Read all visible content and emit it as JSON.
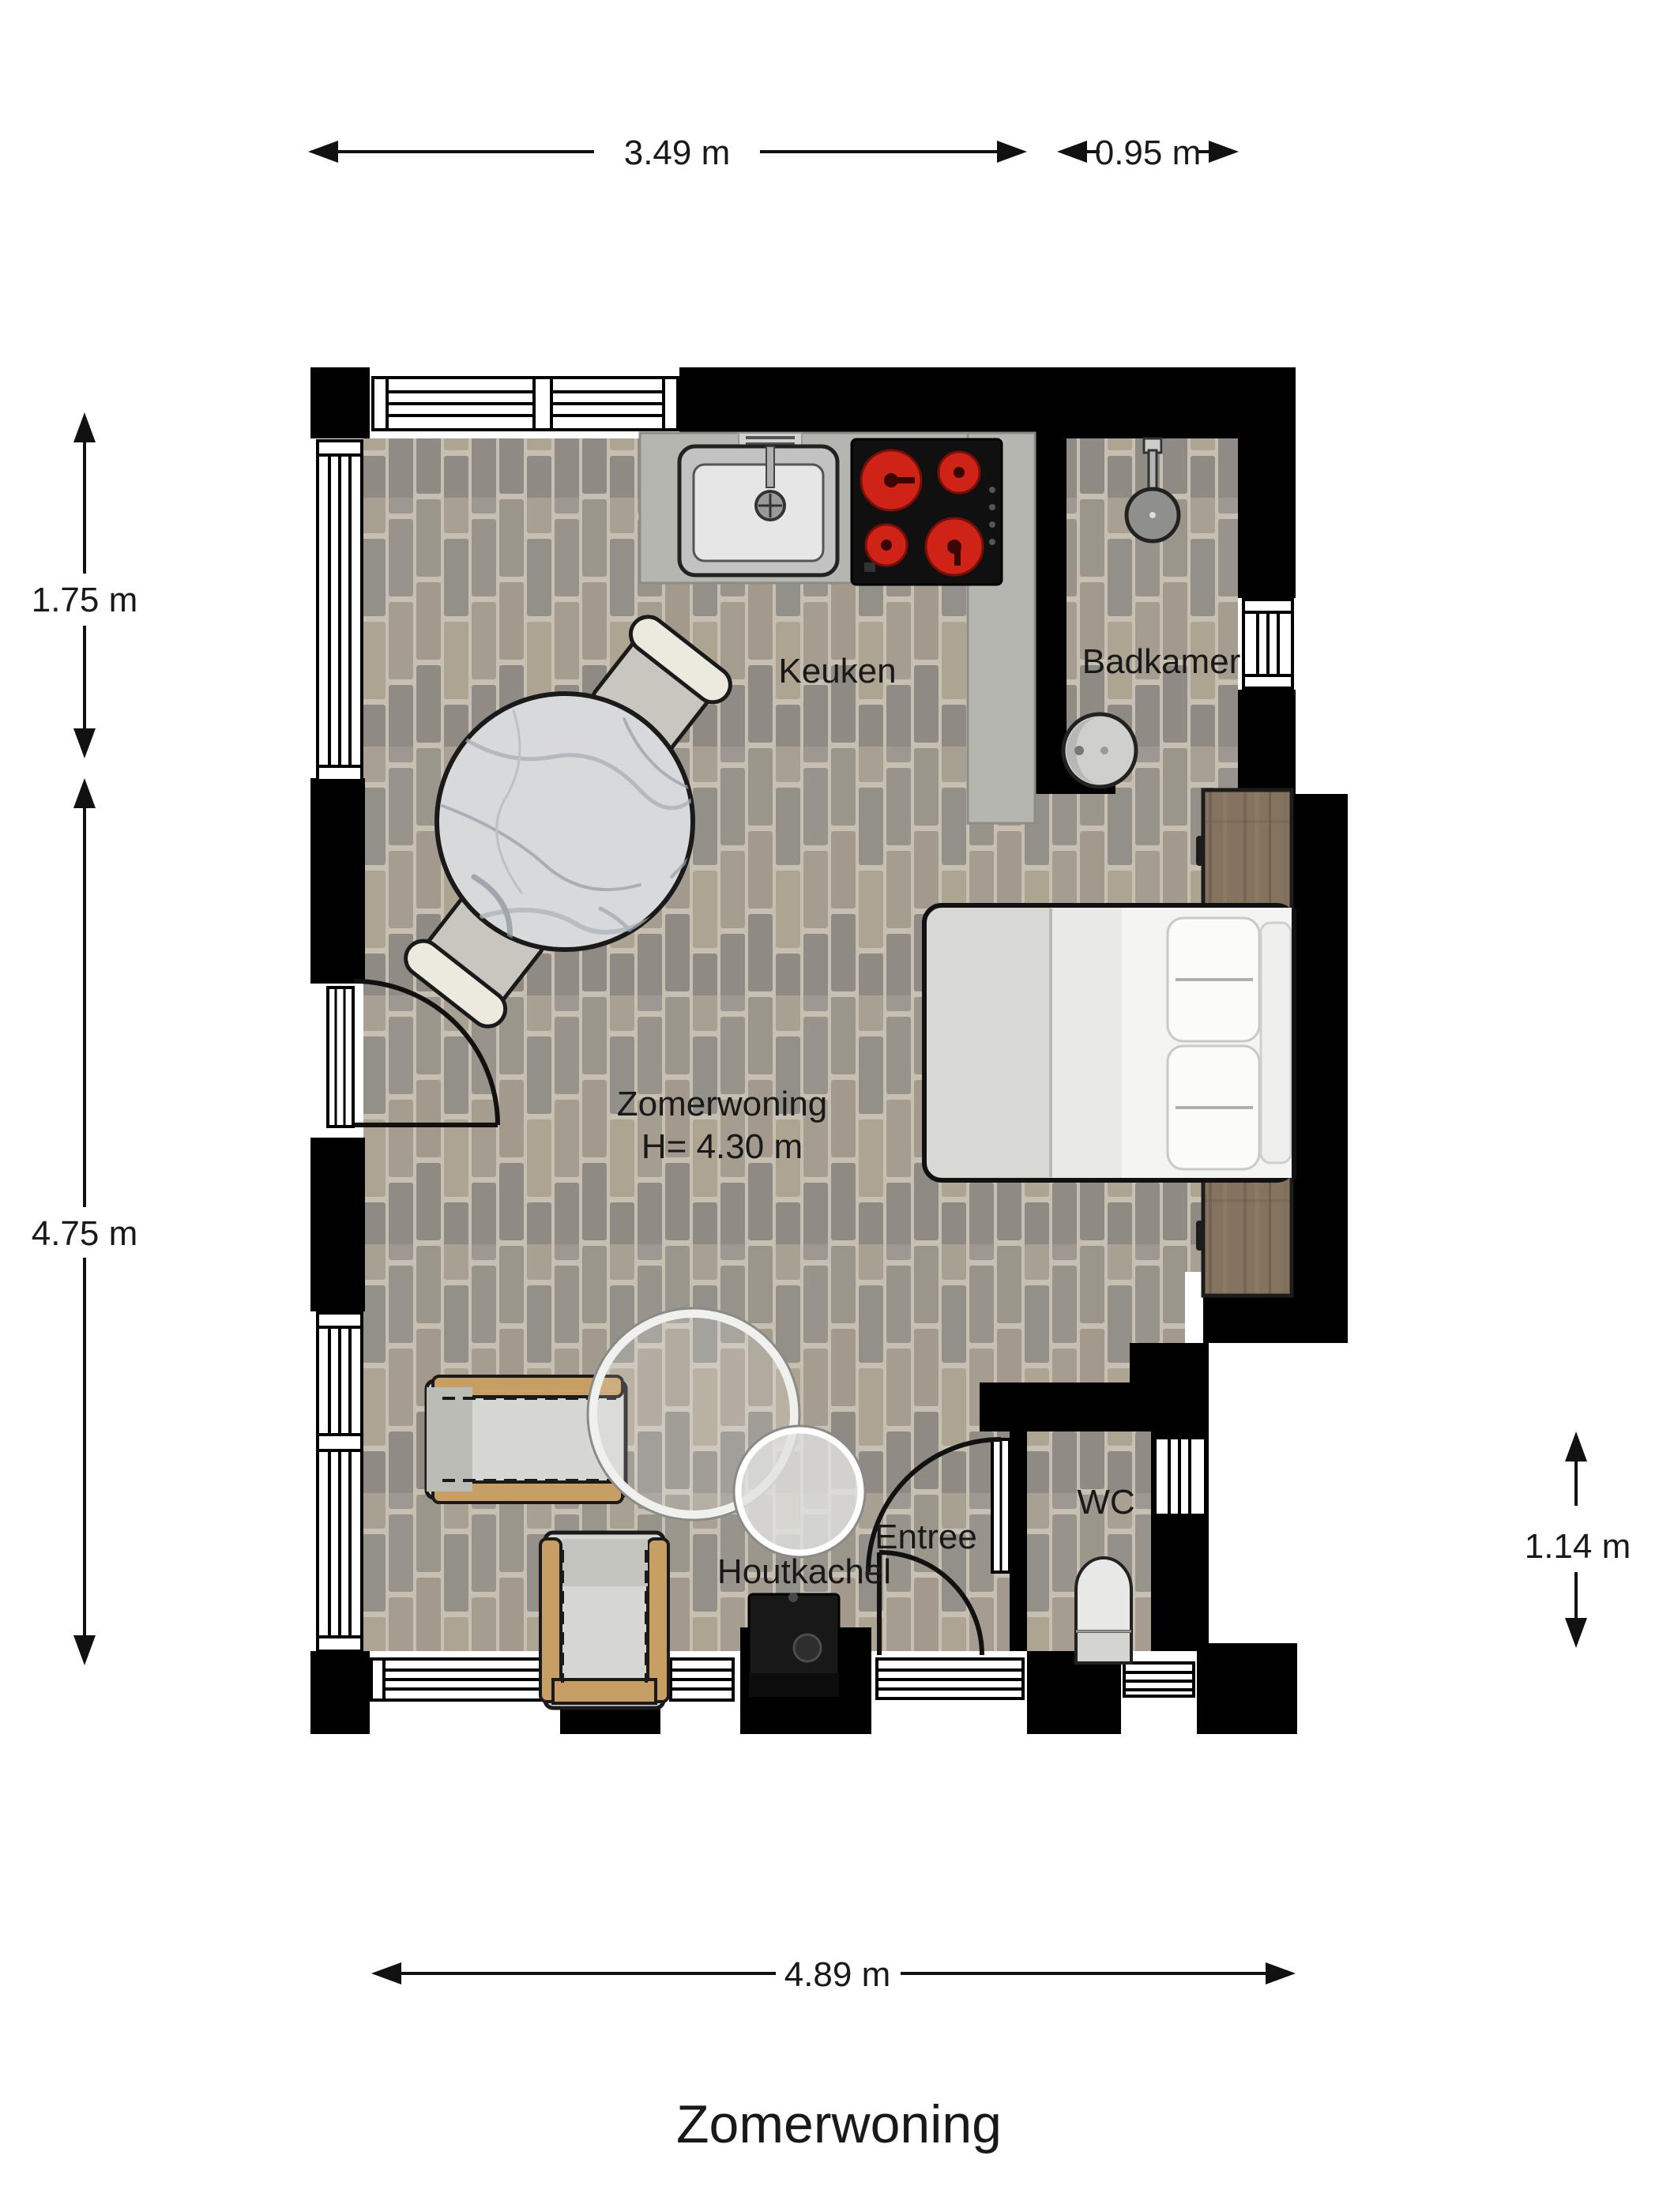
{
  "title": "Zomerwoning",
  "labels": {
    "keuken": "Keuken",
    "badkamer": "Badkamer",
    "main_line1": "Zomerwoning",
    "main_line2": "H= 4.30 m",
    "houtkachel": "Houtkachel",
    "entree": "Entree",
    "wc": "WC"
  },
  "dimensions": {
    "top_left": "3.49 m",
    "top_right": "0.95 m",
    "left_upper": "1.75 m",
    "left_lower": "4.75 m",
    "right_side": "1.14 m",
    "bottom": "4.89 m"
  },
  "colors": {
    "wall": "#000000",
    "floor_grout": "#c6bfb2",
    "floor_brick_1": "#9b968c",
    "floor_brick_2": "#a39a8d",
    "floor_brick_3": "#8f8b84",
    "counter": "#b6b6b1",
    "burner_red": "#cf2318",
    "wood": "#84745f",
    "marble": "#d7d9db",
    "cushion": "#d6d6d2",
    "chair_frame_tan": "#c79e63",
    "stove": "#181818"
  }
}
